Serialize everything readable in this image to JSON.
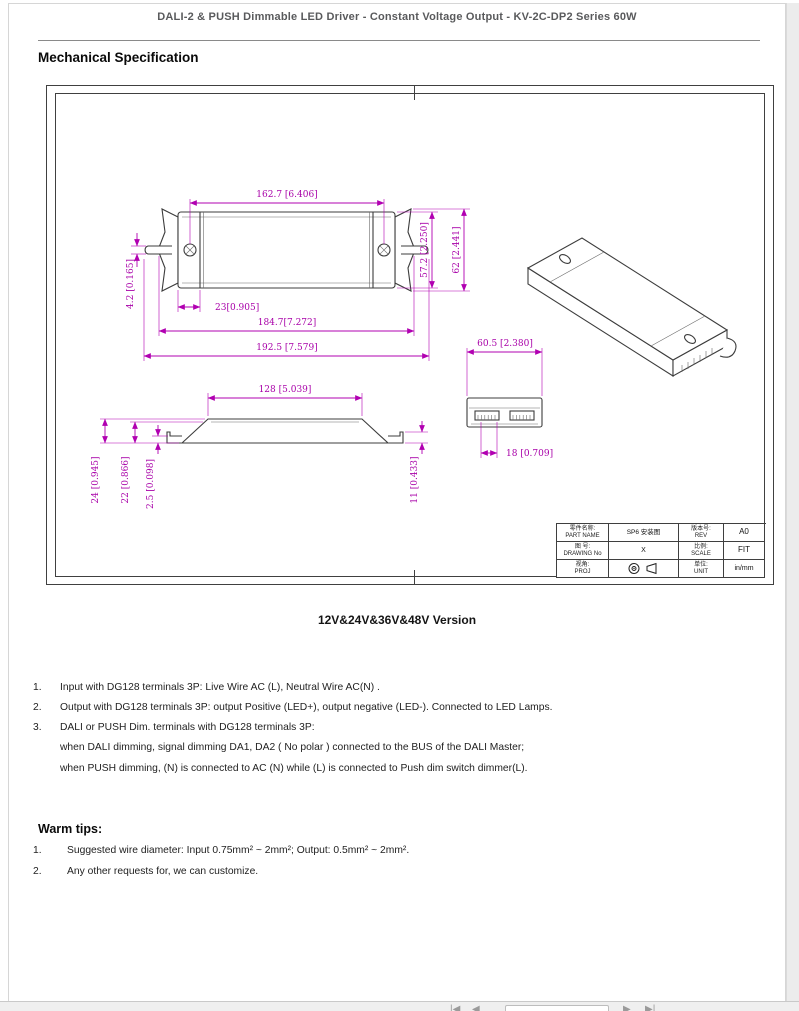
{
  "colors": {
    "dimension_accent": "#b100b1",
    "drawing_line": "#3c3c3c",
    "header_text": "#595a5c"
  },
  "header": {
    "title": "DALI-2 & PUSH Dimmable LED Driver - Constant Voltage Output - KV-2C-DP2 Series 60W",
    "section": "Mechanical Specification"
  },
  "drawing": {
    "top_view": {
      "dim_screw_span": "162.7 [6.406]",
      "dim_body_width": "57.2 [2.250]",
      "dim_overall_width": "62 [2.441]",
      "dim_slot": "4.2 [0.165]",
      "dim_endcap": "23[0.905]",
      "dim_ear_span": "184.7[7.272]",
      "dim_overall_length": "192.5 [7.579]"
    },
    "side_view": {
      "dim_top_length": "128 [5.039]",
      "dim_height_overall": "24 [0.945]",
      "dim_height_body": "22 [0.866]",
      "dim_ear_thickness": "2.5 [0.098]",
      "dim_end_height": "11 [0.433]"
    },
    "end_view": {
      "dim_width": "60.5 [2.380]",
      "dim_terminal": "18 [0.709]"
    },
    "title_block": {
      "part_name_label_cn": "零件名称:",
      "part_name_label_en": "PART NAME",
      "part_name_value": "SP6 安装图",
      "rev_label_cn": "版本号:",
      "rev_label_en": "REV",
      "rev_value": "A0",
      "drawing_no_label_cn": "图 号:",
      "drawing_no_label_en": "DRAWING No",
      "drawing_no_value": "X",
      "scale_label_cn": "比例:",
      "scale_label_en": "SCALE",
      "scale_value": "FIT",
      "proj_label_cn": "视角:",
      "proj_label_en": "PROJ",
      "unit_label_cn": "单位:",
      "unit_label_en": "UNIT",
      "unit_value": "in/mm",
      "proj_icon_name": "first-angle-projection-icon"
    }
  },
  "version_label": "12V&24V&36V&48V Version",
  "notes": {
    "items": [
      {
        "num": "1.",
        "lines": [
          "Input with DG128 terminals 3P: Live Wire AC (L), Neutral Wire AC(N) ."
        ]
      },
      {
        "num": "2.",
        "lines": [
          "Output with DG128 terminals 3P: output Positive (LED+), output negative (LED-). Connected to LED Lamps."
        ]
      },
      {
        "num": "3.",
        "lines": [
          "DALI or PUSH Dim. terminals with DG128 terminals 3P:",
          "when DALI dimming, signal dimming DA1, DA2 ( No polar ) connected to the BUS of the DALI Master;",
          "when PUSH dimming, (N) is connected to AC (N) while (L) is connected to Push dim switch dimmer(L)."
        ]
      }
    ]
  },
  "warm_tips": {
    "title": "Warm tips:",
    "items": [
      {
        "num": "1.",
        "text": "Suggested wire diameter: Input 0.75mm² ~ 2mm²; Output: 0.5mm² ~ 2mm²."
      },
      {
        "num": "2.",
        "text": "Any other requests for, we can customize."
      }
    ]
  },
  "footer": {
    "first_icon": "|◀",
    "prev_icon": "◀",
    "next_icon": "▶",
    "last_icon": "▶|",
    "page_input_value": ""
  }
}
